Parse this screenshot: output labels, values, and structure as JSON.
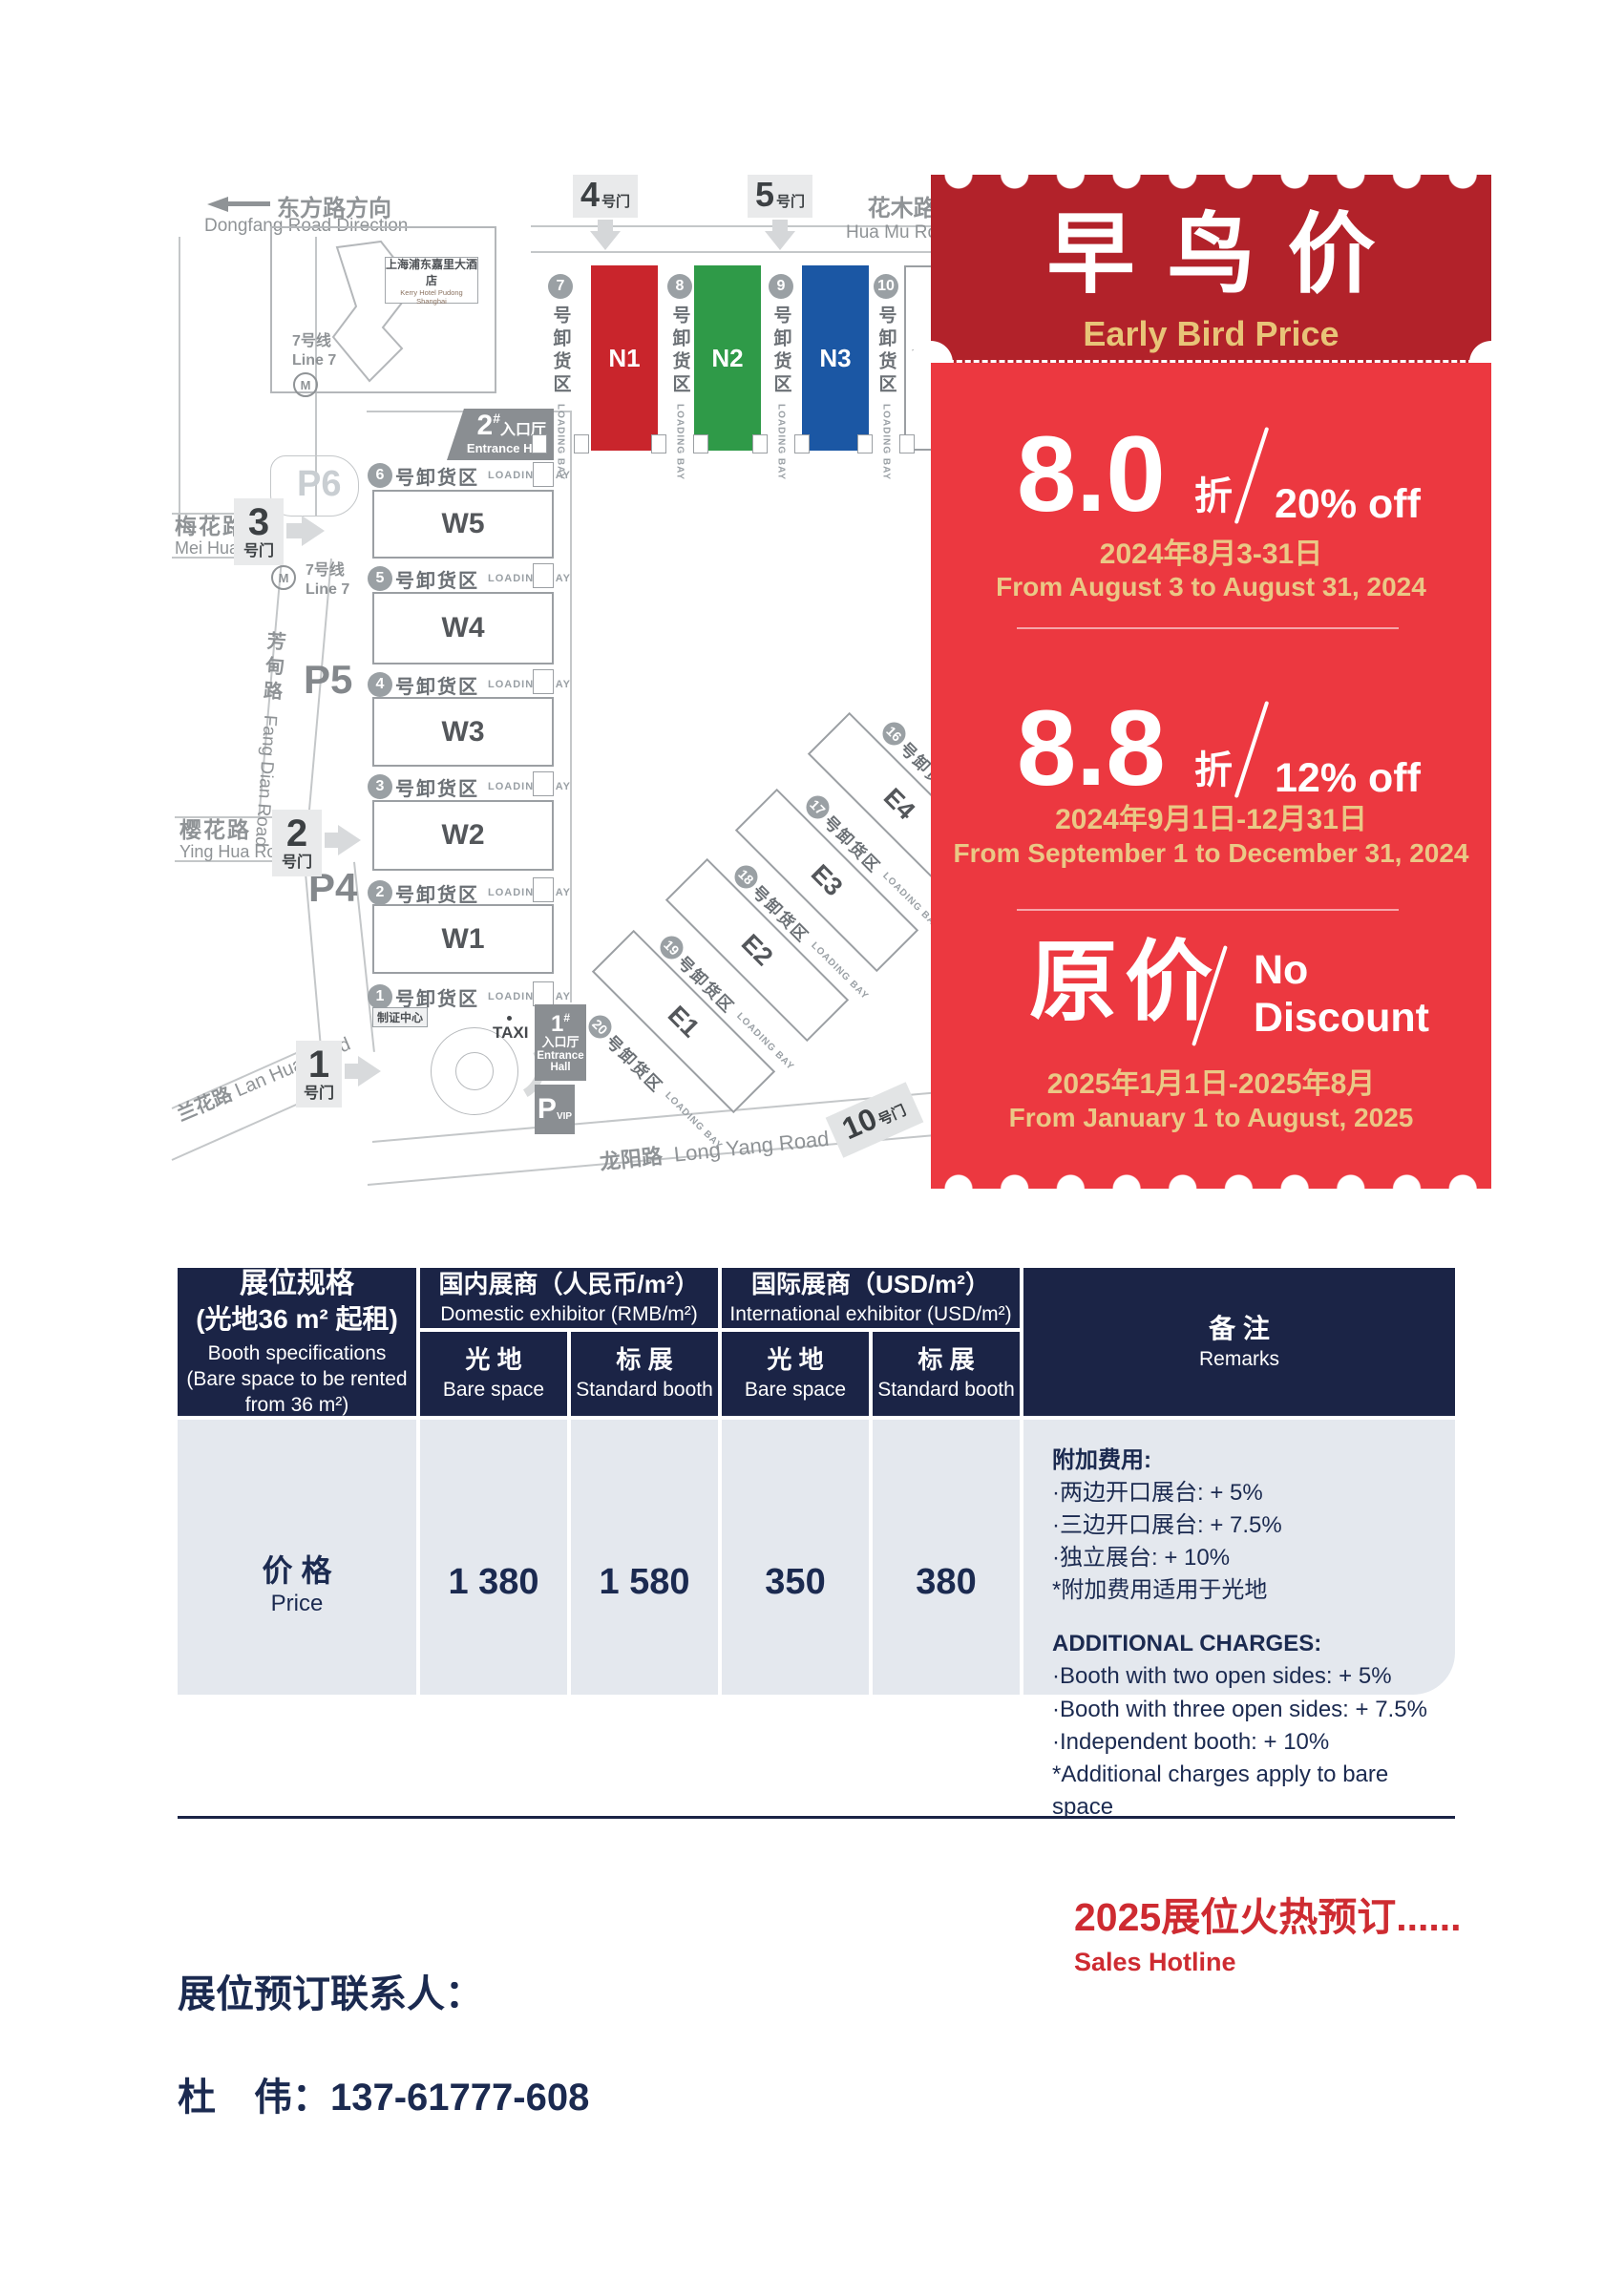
{
  "page": {
    "bg": "#ffffff",
    "navy": "#1b2446",
    "red": "#ce2b31"
  },
  "map": {
    "direction": {
      "cn": "东方路方向",
      "en": "Dongfang Road Direction"
    },
    "gates_top": [
      {
        "num": "4",
        "suffix": "号门"
      },
      {
        "num": "5",
        "suffix": "号门"
      }
    ],
    "road_huamu": {
      "cn": "花木路",
      "en": "Hua Mu Road"
    },
    "hotel": {
      "cn": "上海浦东嘉里大酒店",
      "en": "Kerry Hotel Pudong Shanghai"
    },
    "metro": {
      "cn": "7号线",
      "en": "Line 7",
      "logo": "M"
    },
    "entrance2": {
      "num": "2",
      "hash": "#",
      "cn": "入口厅",
      "en": "Entrance Hall"
    },
    "entrance1": {
      "num": "1",
      "hash": "#",
      "cn": "入口厅",
      "en1": "Entrance",
      "en2": "Hall"
    },
    "vip": {
      "p": "P",
      "vip": "VIP"
    },
    "parking": {
      "p6": "P6",
      "p5": "P5",
      "p4": "P4"
    },
    "road_meihua": {
      "cn": "梅花路",
      "en": "Mei Hua Road"
    },
    "road_fangdian": {
      "cn": "芳甸路",
      "en": "Fang Dian Road"
    },
    "road_yinghua": {
      "cn": "樱花路",
      "en": "Ying Hua Road"
    },
    "road_lanhua": {
      "cn": "兰花路",
      "en": "Lan Hua Road"
    },
    "road_longyang": {
      "cn": "龙阳路",
      "en": "Long Yang Road"
    },
    "gates_left": [
      {
        "num": "3",
        "suffix": "号门"
      },
      {
        "num": "2",
        "suffix": "号门"
      },
      {
        "num": "1",
        "suffix": "号门"
      }
    ],
    "gate10": {
      "num": "10",
      "suffix": "号门"
    },
    "badge_center": "制证中心",
    "taxi": "TAXI",
    "bay_text": {
      "cn": "号卸货区",
      "en": "LOADING BAY"
    },
    "n_halls": [
      {
        "label": "N1",
        "color": "#c9252c"
      },
      {
        "label": "N2",
        "color": "#2f9a48"
      },
      {
        "label": "N3",
        "color": "#1b57a4"
      },
      {
        "label": "N4",
        "color": "#ffffff"
      }
    ],
    "w_halls": [
      "W5",
      "W4",
      "W3",
      "W2",
      "W1"
    ],
    "e_halls": [
      "E4",
      "E3",
      "E2",
      "E1"
    ],
    "bays_n": [
      "7",
      "8",
      "9",
      "10"
    ],
    "bays_w": [
      "6",
      "5",
      "4",
      "3",
      "2",
      "1"
    ],
    "bays_e": [
      "16",
      "17",
      "18",
      "19",
      "20"
    ]
  },
  "ticket": {
    "title_cn": "早鸟价",
    "title_en": "Early Bird Price",
    "colors": {
      "header": "#b2222a",
      "body": "#ec3840",
      "gold": "#eac886"
    },
    "tiers": [
      {
        "value": "8.0",
        "unit": "折",
        "discount": "20% off",
        "date_cn": "2024年8月3-31日",
        "date_en": "From August 3 to August 31, 2024"
      },
      {
        "value": "8.8",
        "unit": "折",
        "discount": "12% off",
        "date_cn": "2024年9月1日-12月31日",
        "date_en": "From September 1 to December 31, 2024"
      },
      {
        "value": "原价",
        "discount_line1": "No",
        "discount_line2": "Discount",
        "date_cn": "2025年1月1日-2025年8月",
        "date_en": "From January 1 to August, 2025"
      }
    ]
  },
  "table": {
    "spec": {
      "cn1": "展位规格",
      "cn2": "(光地36 m² 起租)",
      "en1": "Booth specifications",
      "en2": "(Bare space to be rented",
      "en3": "from 36 m²)"
    },
    "domestic": {
      "cn": "国内展商（人民币/m²）",
      "en": "Domestic exhibitor (RMB/m²)"
    },
    "international": {
      "cn": "国际展商（USD/m²）",
      "en": "International exhibitor (USD/m²)"
    },
    "remarks": {
      "cn": "备 注",
      "en": "Remarks"
    },
    "sub_bare": {
      "cn": "光 地",
      "en": "Bare space"
    },
    "sub_std": {
      "cn": "标 展",
      "en": "Standard booth"
    },
    "price_row": {
      "cn": "价 格",
      "en": "Price",
      "values": [
        "1 380",
        "1 580",
        "350",
        "380"
      ]
    },
    "remarks_cn": [
      "附加费用:",
      "·两边开口展台: + 5%",
      "·三边开口展台: + 7.5%",
      "·独立展台: + 10%",
      "*附加费用适用于光地"
    ],
    "remarks_en": [
      "ADDITIONAL CHARGES:",
      "·Booth with two open sides: + 5%",
      "·Booth with three open sides: + 7.5%",
      "·Independent booth: + 10%",
      "*Additional charges apply to bare space"
    ]
  },
  "footer": {
    "hotline_cn": "2025展位火热预订......",
    "hotline_en": "Sales Hotline",
    "contact_label": "展位预订联系人：",
    "contact": "杜　伟：137-61777-608"
  }
}
